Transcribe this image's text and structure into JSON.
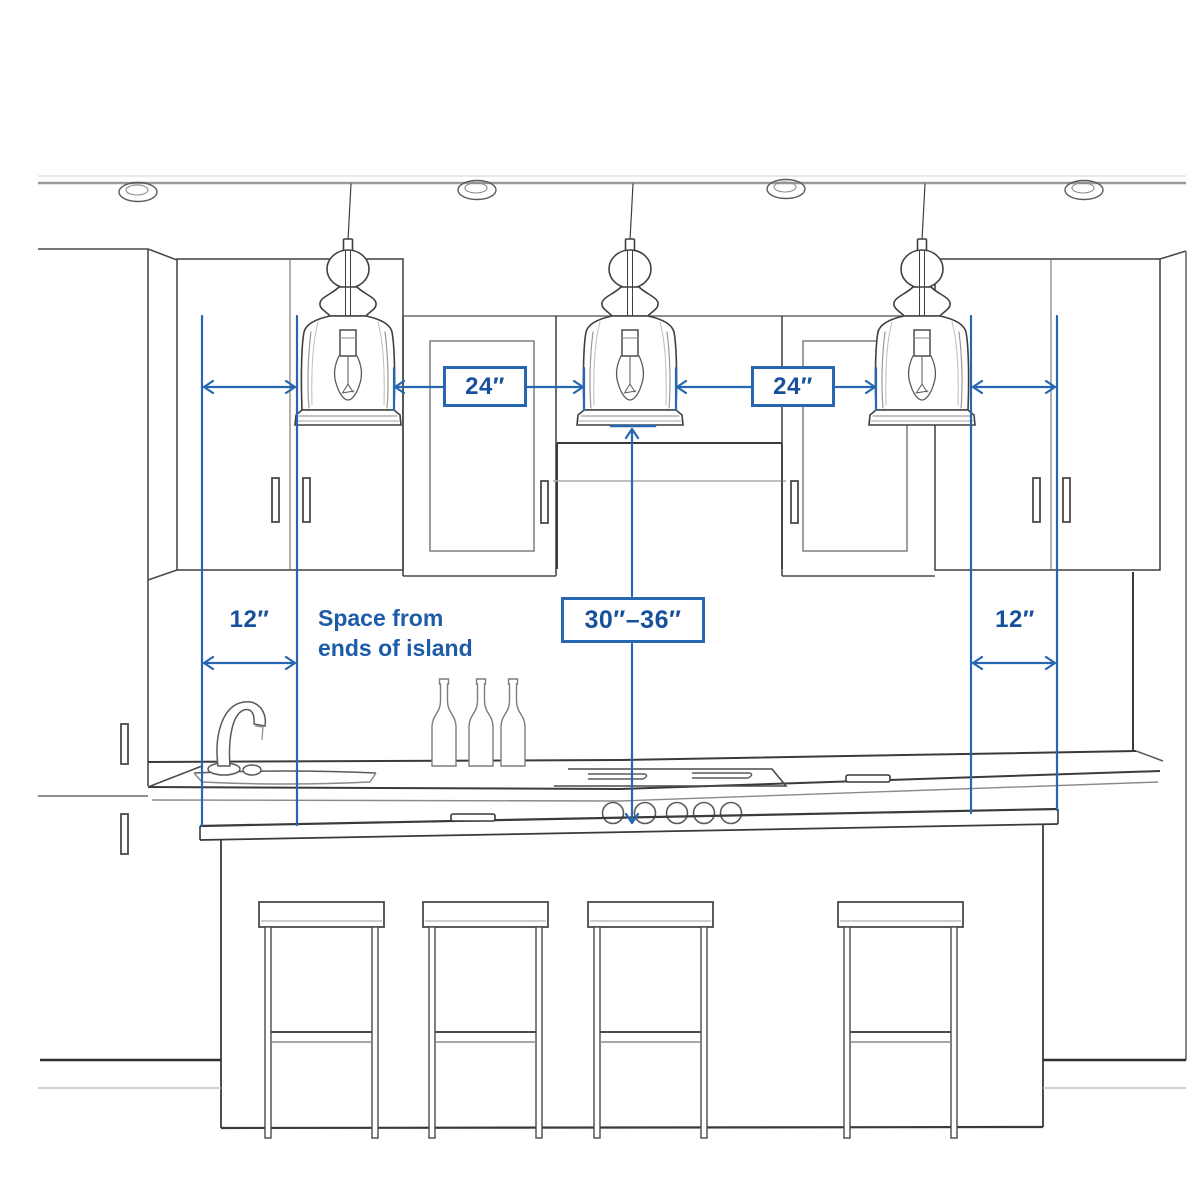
{
  "labels": {
    "pendant_spacing_left": "24″",
    "pendant_spacing_right": "24″",
    "island_end_space_left": "12″",
    "island_end_space_right": "12″",
    "pendant_height_range": "30″–36″",
    "note_line1": "Space from",
    "note_line2": "ends of island"
  },
  "colors": {
    "dimension_blue": "#2767b1",
    "label_text_blue": "#17519e",
    "sketch_line_gray": "#4a4a4a"
  },
  "icons": [
    "pendant-light-icon",
    "recessed-light-icon",
    "faucet-icon",
    "wine-bottle-icon",
    "cooktop-icon",
    "control-knob-icon",
    "bar-stool-icon",
    "cabinet-handle-icon"
  ]
}
